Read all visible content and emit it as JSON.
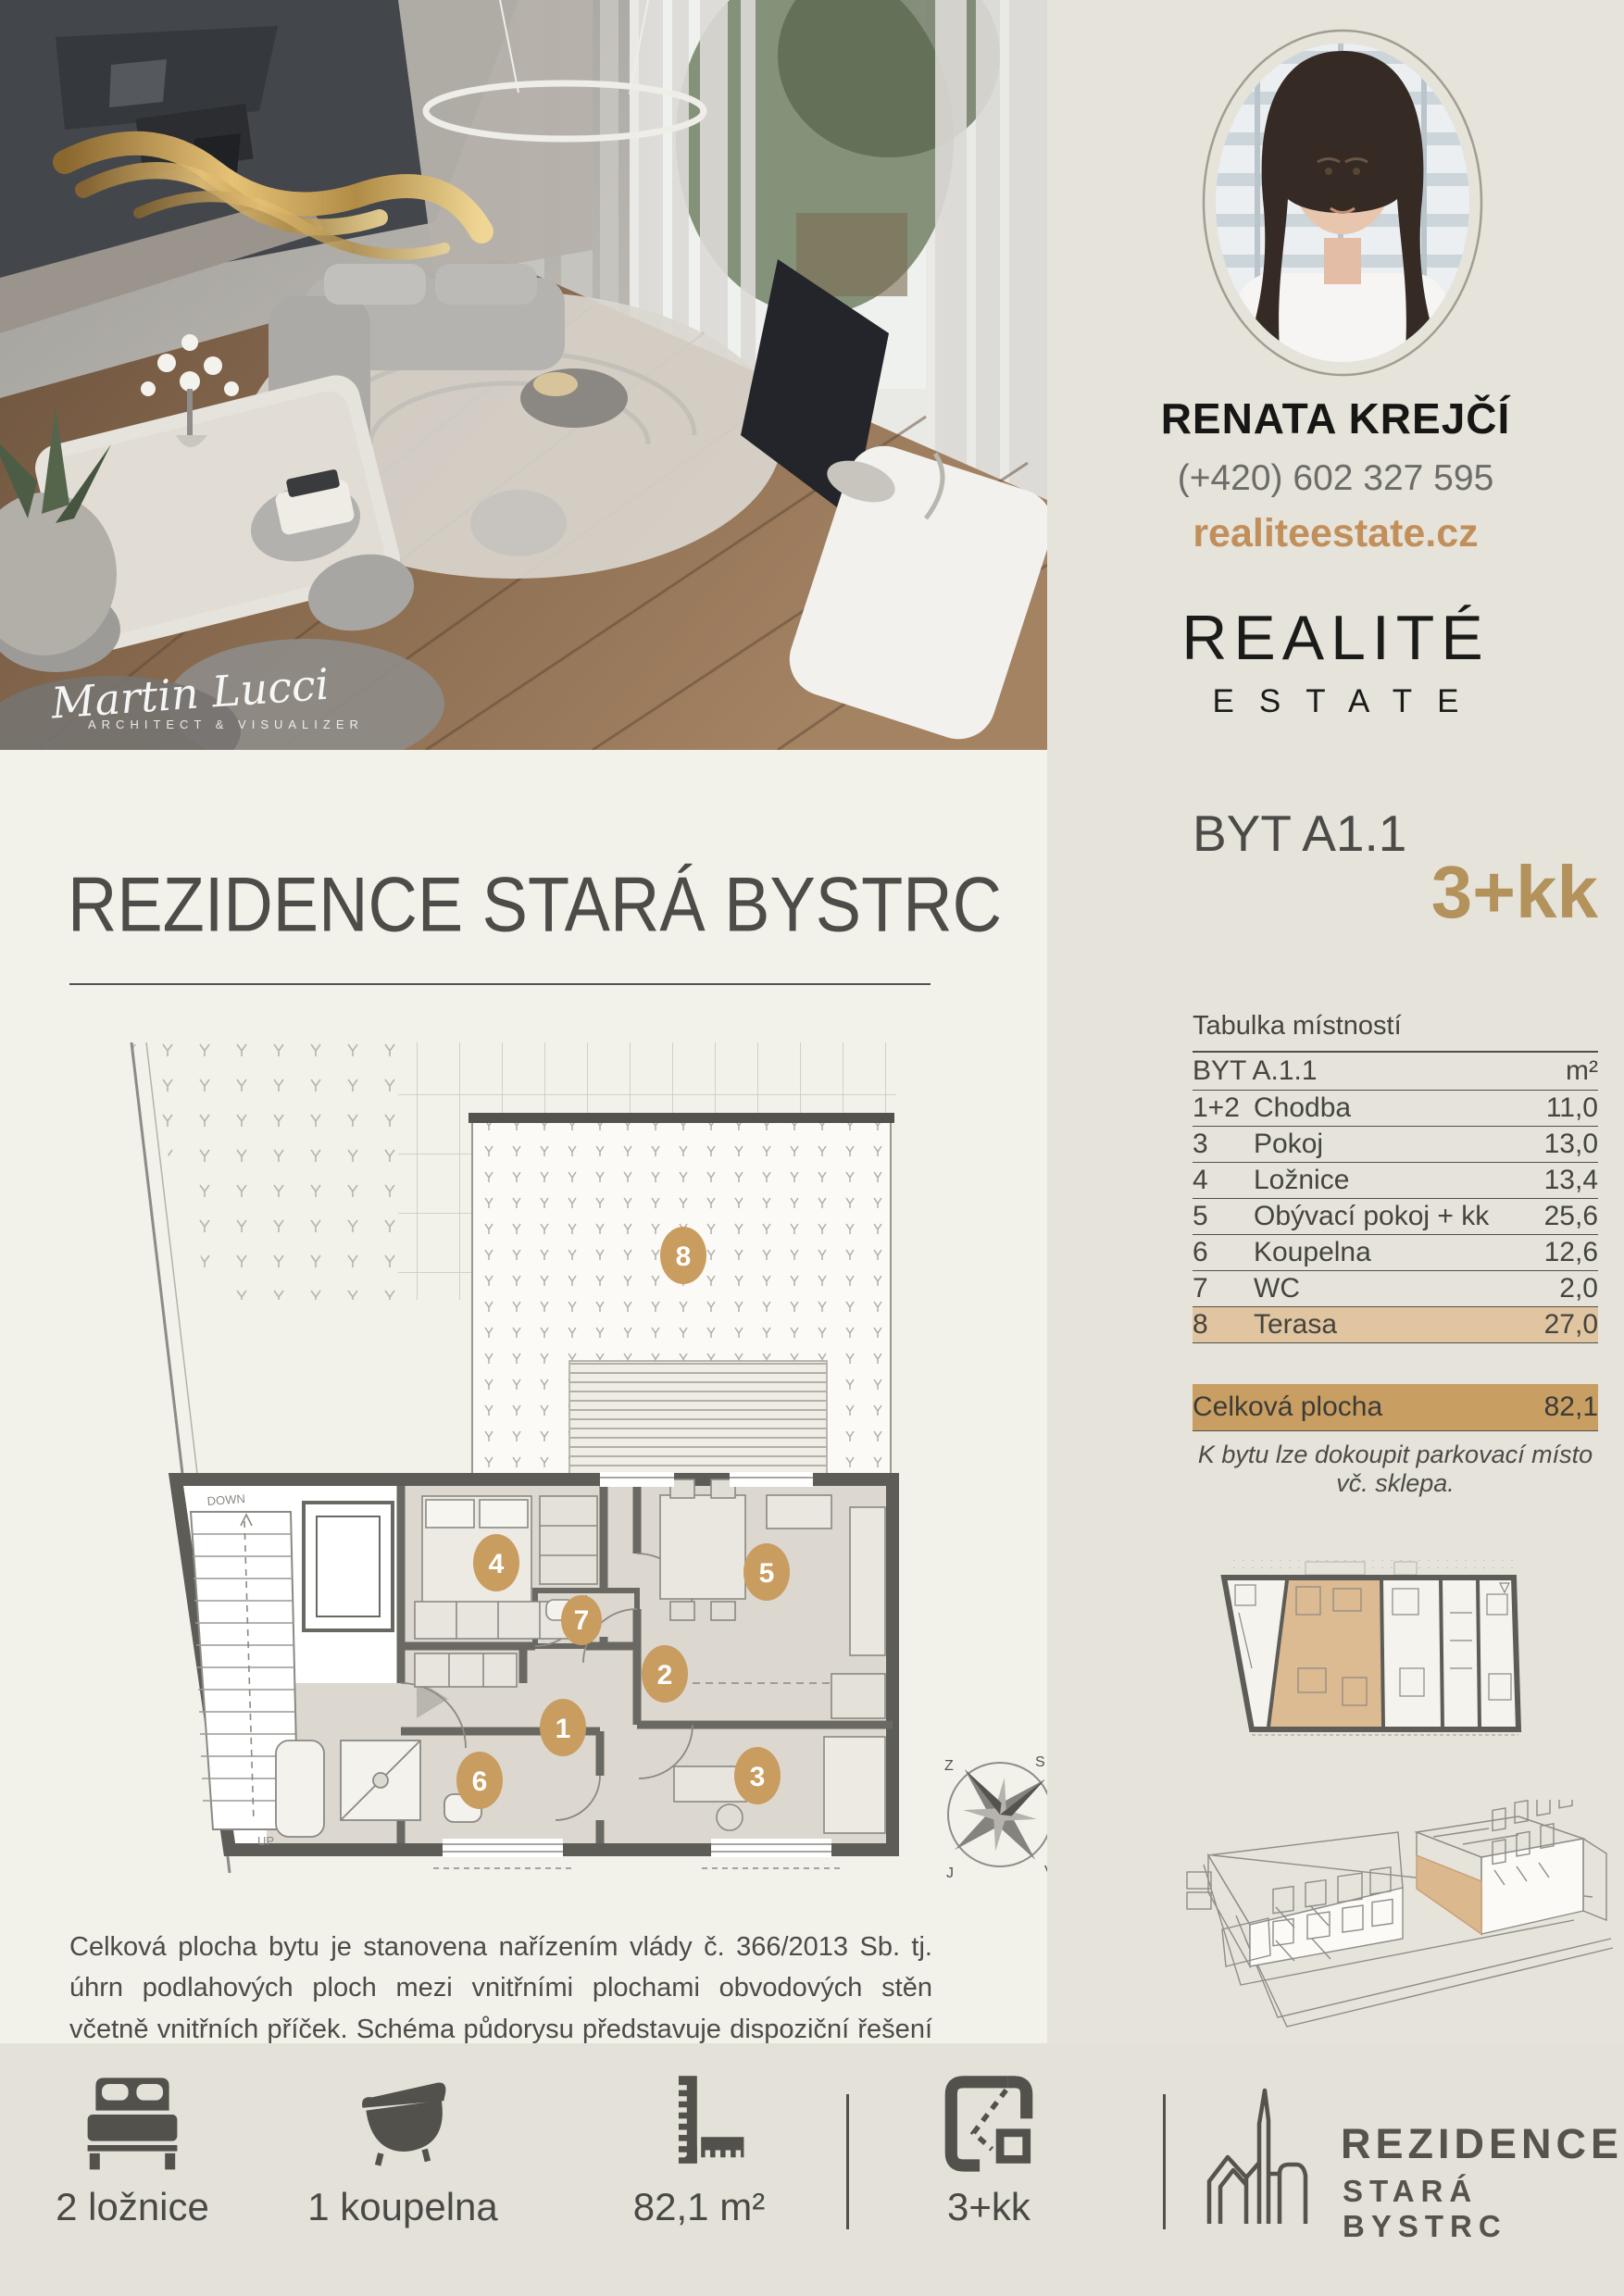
{
  "photo": {
    "watermark_name": "Martin Lucci",
    "watermark_sub": "ARCHITECT & VISUALIZER"
  },
  "agent": {
    "name": "RENATA KREJČÍ",
    "phone": "(+420) 602 327 595",
    "website": "realiteestate.cz",
    "brand_line1": "REALITÉ",
    "brand_line2": "ESTATE"
  },
  "listing": {
    "unit": "BYT A1.1",
    "layout": "3+kk"
  },
  "project": {
    "title": "REZIDENCE STARÁ BYSTRC"
  },
  "room_table": {
    "title": "Tabulka místností",
    "header": {
      "label": "BYT A.1.1",
      "unit": "m²"
    },
    "rows": [
      {
        "num": "1+2",
        "label": "Chodba",
        "value": "11,0"
      },
      {
        "num": "3",
        "label": "Pokoj",
        "value": "13,0"
      },
      {
        "num": "4",
        "label": "Ložnice",
        "value": "13,4"
      },
      {
        "num": "5",
        "label": "Obývací pokoj + kk",
        "value": "25,6"
      },
      {
        "num": "6",
        "label": "Koupelna",
        "value": "12,6"
      },
      {
        "num": "7",
        "label": "WC",
        "value": "2,0"
      },
      {
        "num": "8",
        "label": "Terasa",
        "value": "27,0"
      }
    ],
    "total": {
      "label": "Celková plocha",
      "value": "82,1"
    },
    "note": "K bytu lze dokoupit parkovací místo vč. sklepa."
  },
  "floor_plan": {
    "rooms": [
      "1",
      "2",
      "3",
      "4",
      "5",
      "6",
      "7",
      "8"
    ],
    "stairs_down": "DOWN",
    "stairs_up": "UP",
    "compass": {
      "north": "S",
      "east": "V",
      "south": "J",
      "west": "Z"
    }
  },
  "disclaimer": "Celková plocha bytu je stanovena nařízením vlády č. 366/2013 Sb. tj. úhrn podlahových ploch mezi vnitřními plochami obvodových stěn včetně vnitřních příček. Schéma půdorysu představuje dispoziční řešení bytu. Vyobrazené vybavení má pouze ilustrační charakter.",
  "footer": {
    "stats": [
      {
        "icon": "bed-icon",
        "label": "2 ložnice"
      },
      {
        "icon": "bath-icon",
        "label": "1 koupelna"
      },
      {
        "icon": "ruler-icon",
        "label": "82,1 m²"
      },
      {
        "icon": "plan-icon",
        "label": "3+kk"
      }
    ],
    "logo": {
      "line1": "REZIDENCE",
      "line2": "STARÁ BYSTRC"
    }
  },
  "colors": {
    "accent_gold": "#c28f5b",
    "row_highlight": "#e0c5a0",
    "total_band": "#c89e62",
    "panel_bg": "#e5e3da",
    "paper_bg": "#f2f1ea"
  }
}
